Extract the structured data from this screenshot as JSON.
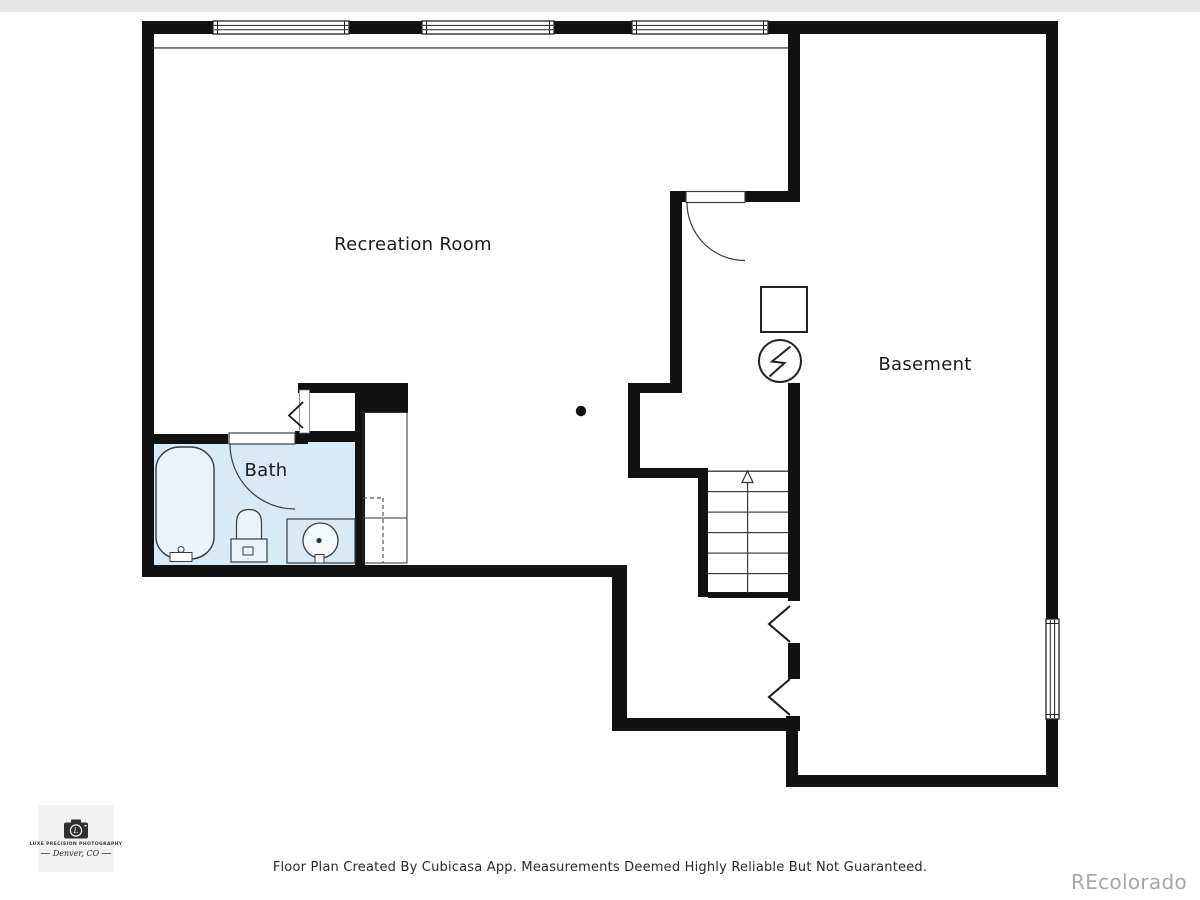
{
  "colors": {
    "wall": "#111111",
    "outline": "#3c3c3c",
    "bath_floor": "#d9eaf7",
    "fixture_fill": "#e9f3fb",
    "sink_fill": "#f4fafe"
  },
  "rooms": {
    "recreation": {
      "label": "Recreation Room"
    },
    "bath": {
      "label": "Bath"
    },
    "basement": {
      "label": "Basement"
    }
  },
  "footer": {
    "disclaimer": "Floor Plan Created By Cubicasa App. Measurements Deemed Highly Reliable But Not Guaranteed.",
    "watermark": "REcolorado"
  },
  "logo": {
    "line1": "LUXE PRECISION PHOTOGRAPHY",
    "line2": "Denver, CO"
  }
}
